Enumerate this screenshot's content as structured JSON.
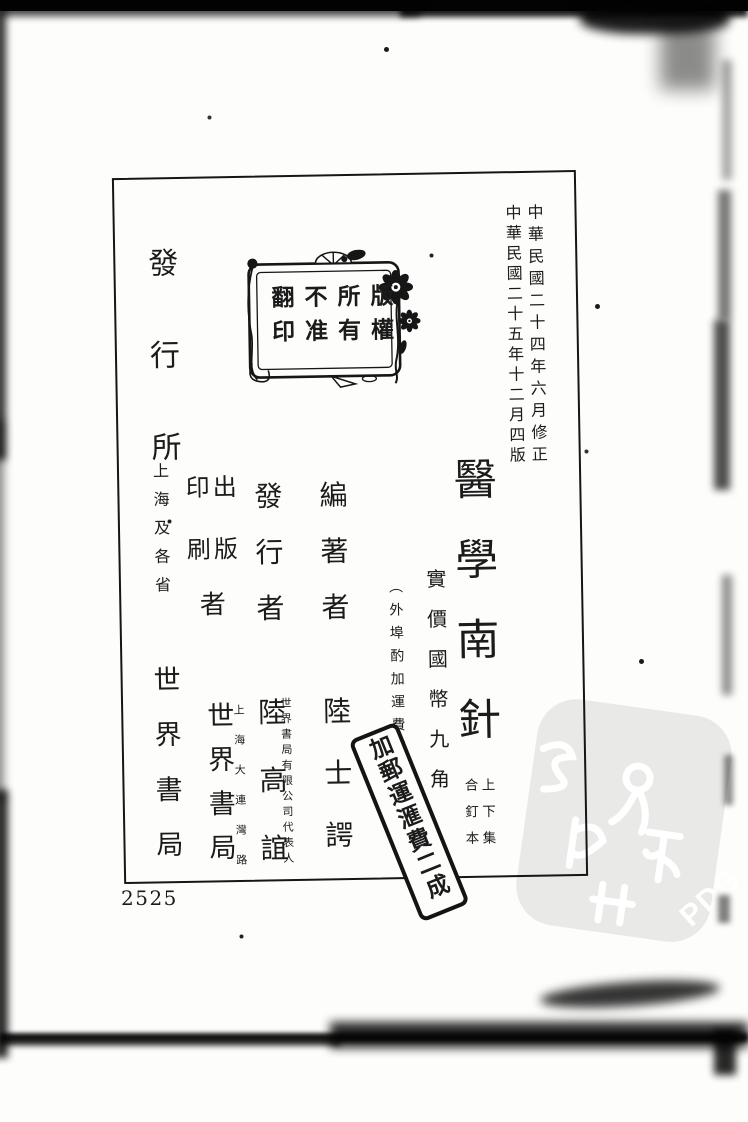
{
  "document": {
    "serial_number": "2525",
    "edition_notice": {
      "revised": "中華民國二十四年六月修正",
      "printed": "中華民國二十五年十二月四版"
    },
    "copyright_seal": {
      "columns": [
        "版權",
        "所有",
        "不准",
        "翻印"
      ]
    },
    "title_block": {
      "title": "醫學南針",
      "binding_right": "上下集",
      "binding_left": "合釘本",
      "price": "實價國幣九角",
      "price_note": "（外埠酌加運費滙費）"
    },
    "imprint": {
      "editor": {
        "role": "編著者",
        "name": "陸士諤"
      },
      "publisher": {
        "role": "發行者",
        "name": "陸高誼",
        "annotation": "世界書局有限公司代表人"
      },
      "printer": {
        "role_right": "出版",
        "role_left": "印刷",
        "role_suffix": "者",
        "name": "世界書局",
        "annotation": "上海大連灣路"
      },
      "distributor": {
        "role": "發行所",
        "region": "上海及各省",
        "name": "世界書局"
      }
    },
    "surcharge_stamp": "加郵運滙費二成",
    "watermark_label": "PDG"
  },
  "colors": {
    "ink": "#1b1b1b",
    "paper": "#fdfdfb",
    "watermark_gray": "#e9e9e7"
  }
}
